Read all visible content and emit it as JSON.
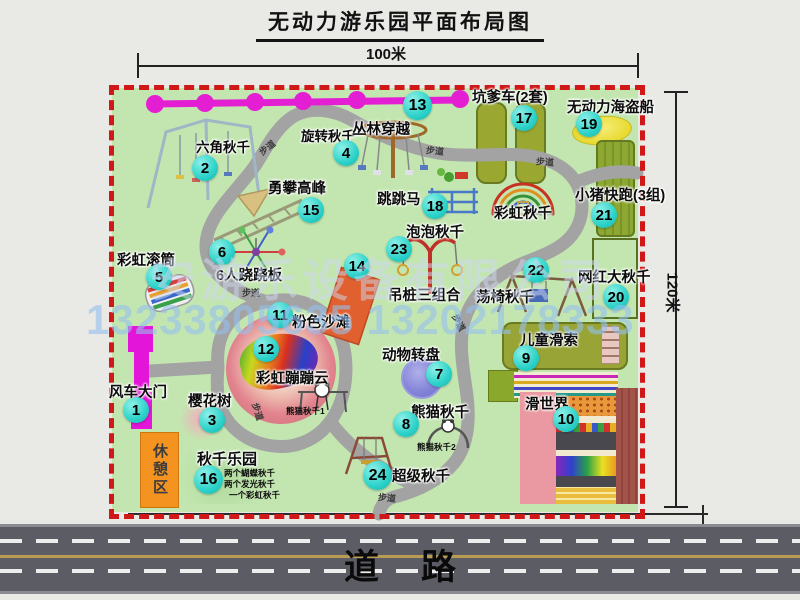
{
  "title": "无动力游乐园平面布局图",
  "dimensions": {
    "width": "100米",
    "height": "120米"
  },
  "road": {
    "label": "道路"
  },
  "watermark": {
    "company": "安游乐设备有限公司",
    "phone": "13233805635 13202178333"
  },
  "rest_area": {
    "label": "休憩区"
  },
  "path_label": "步道",
  "rainbow_swing_label": "彩虹秋千",
  "attractions": [
    {
      "num": "1",
      "label": "风车大门"
    },
    {
      "num": "2",
      "label": "六角秋千"
    },
    {
      "num": "3",
      "label": "樱花树"
    },
    {
      "num": "4",
      "label": "旋转秋千"
    },
    {
      "num": "5",
      "label": "彩虹滚筒"
    },
    {
      "num": "6",
      "label": "6人跷跷板"
    },
    {
      "num": "7",
      "label": "动物转盘"
    },
    {
      "num": "8",
      "label": "熊猫秋千",
      "sub1": "熊猫秋千1",
      "sub2": "熊猫秋千2"
    },
    {
      "num": "9",
      "label": "儿童滑索"
    },
    {
      "num": "10",
      "label": "滑世界"
    },
    {
      "num": "11",
      "label": "粉色沙滩"
    },
    {
      "num": "12",
      "label": "彩虹蹦蹦云"
    },
    {
      "num": "13",
      "label": "丛林穿越"
    },
    {
      "num": "14",
      "label": "吊桩三组合"
    },
    {
      "num": "15",
      "label": "勇攀高峰"
    },
    {
      "num": "16",
      "label": "秋千乐园",
      "notes": [
        "两个蝴蝶秋千",
        "两个发光秋千",
        "一个彩虹秋千"
      ]
    },
    {
      "num": "17",
      "label": "坑爹车(2套)"
    },
    {
      "num": "18",
      "label": "跳跳马"
    },
    {
      "num": "19",
      "label": "无动力海盗船"
    },
    {
      "num": "20",
      "label": "网红大秋千"
    },
    {
      "num": "21",
      "label": "小猪快跑(3组)"
    },
    {
      "num": "22",
      "label": "荡椅秋千"
    },
    {
      "num": "23",
      "label": "泡泡秋千"
    },
    {
      "num": "24",
      "label": "超级秋千"
    }
  ],
  "colors": {
    "map_green": "#c3e6b0",
    "border_red": "#d01818",
    "badge_cyan": "#2cd2c9",
    "path_gray": "#a3a3a3",
    "gate_magenta": "#e315d8",
    "chain_magenta": "#e41fd3",
    "rest_orange": "#f49320",
    "road_gray": "#5c5c64",
    "pirate_yellow": "#e8da30",
    "carousel_purple": "#8282d8",
    "beach_pink": "#e2838e",
    "olive_green": "#8ca832"
  }
}
